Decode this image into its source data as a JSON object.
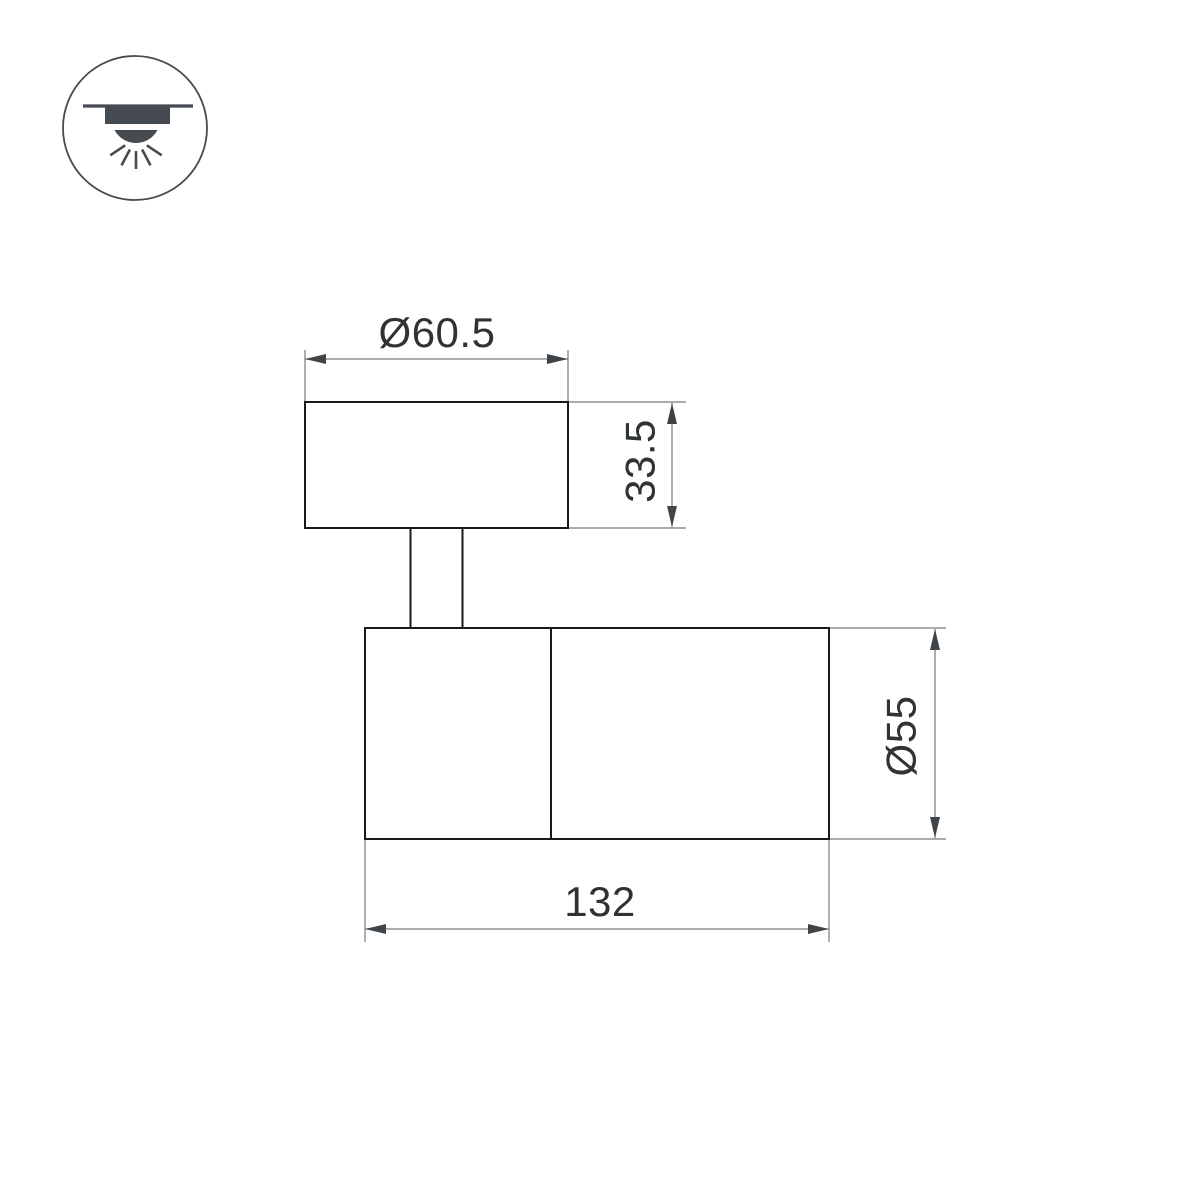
{
  "page": {
    "background": "#ffffff",
    "type": "product-dimension-drawing"
  },
  "mount_icon": {
    "name": "surface-ceiling-downlight"
  },
  "dimensions": {
    "cap_diameter": {
      "label": "Ø60.5",
      "value": 60.5
    },
    "cap_height": {
      "label": "33.5",
      "value": 33.5
    },
    "body_diameter": {
      "label": "Ø55",
      "value": 55
    },
    "body_length": {
      "label": "132",
      "value": 132
    }
  },
  "colors": {
    "outline": "#1a1a1a",
    "dimension_line": "#7a7a7a",
    "arrow": "#3f4448",
    "label_text": "#303336",
    "icon": "#454b50",
    "background": "#ffffff"
  }
}
